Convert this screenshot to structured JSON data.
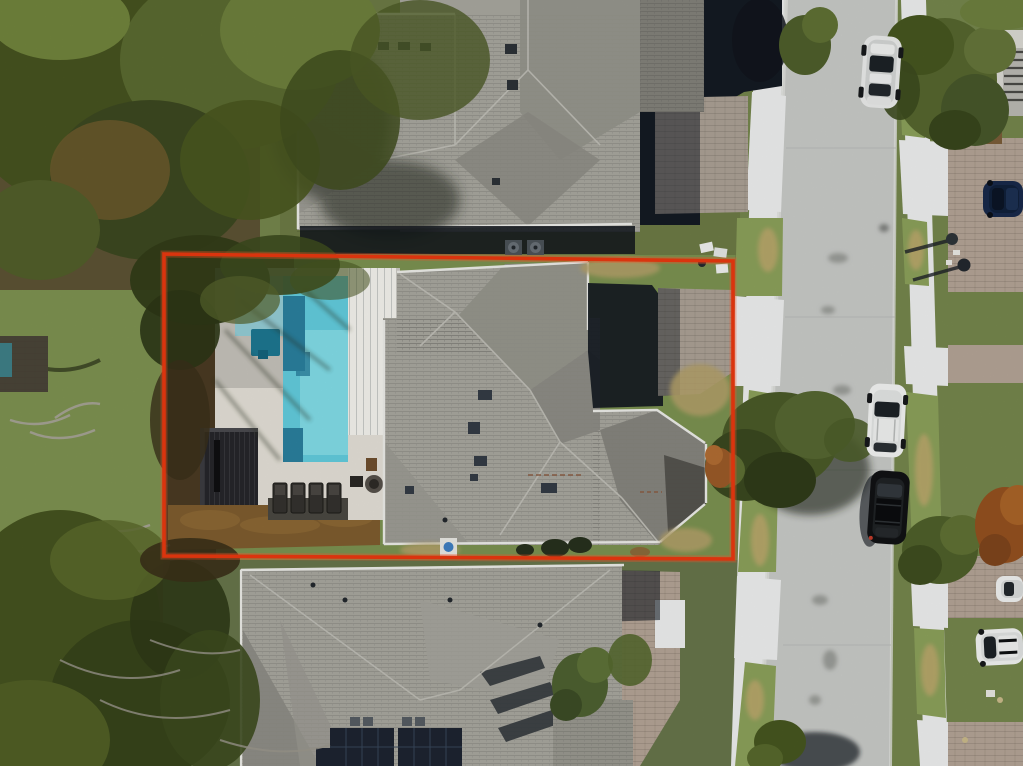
{
  "meta": {
    "type": "aerial-drone-photo",
    "subject": "residential lot highlighted with red boundary, house with swimming pool, street with parked cars",
    "width_px": 1023,
    "height_px": 766
  },
  "colors": {
    "boundary": "#e8380f",
    "grass_base": "#74854c",
    "grass_light": "#8ba05a",
    "grass_tan": "#bfa76d",
    "lawn_lot": "#7b9150",
    "lawn_dry": "#b3a069",
    "canopy_dark": "#39451f",
    "canopy_mid": "#51622e",
    "canopy_light": "#70833c",
    "canopy_brown": "#6e5a31",
    "mulch": "#7e5c2e",
    "mulch_dark": "#4e3a1d",
    "road": "#c7c9c6",
    "road_light": "#d4d6d2",
    "sidewalk": "#eceded",
    "paver": "#aaa094",
    "paver_warm": "#b3a395",
    "roof_light": "#a7a69e",
    "roof_mid": "#94938b",
    "roof_dark": "#82817a",
    "roof_facet_shadow": "#6e6d66",
    "gutter_white": "#ebebe7",
    "shadow_deep": "#141a22",
    "pool_water": "#62cbdc",
    "pool_water_light": "#8adfe8",
    "pool_water_shade": "#93cbd4",
    "pool_dark_step": "#2a7f9d",
    "spa": "#1d7690",
    "deck": "#e3dfd6",
    "deck_shade": "#a09c95",
    "lanai_roof": "#f3f2ec",
    "pergola": "#26262a",
    "car_white": "#f0f1f0",
    "car_black": "#101214",
    "car_navy": "#18294a",
    "car_glass": "#1c2126",
    "solar_panel": "#1d2430",
    "ac_unit": "#3f464e",
    "equipment_blue": "#3f7fc1",
    "shed_teal": "#3e7f86"
  },
  "scene": {
    "boundary_shape": "red rectangle outlining the center lot",
    "houses_visible": 3,
    "pools_visible": 1,
    "counts": {
      "cars": 6,
      "lounge_chairs": 4,
      "mailboxes": 2,
      "solar_panel_arrays": 3,
      "ac_units": 2,
      "trash_bins": 3
    },
    "objects": [
      "subject-house-roof",
      "swimming-pool",
      "spa",
      "covered-lanai",
      "pergola",
      "lounge-chairs",
      "fire-pit-table",
      "pool-equipment-pad",
      "paver-driveway",
      "top-neighbor-house",
      "bottom-neighbor-house",
      "solar-panels",
      "street",
      "left-sidewalk",
      "right-sidewalk",
      "grass-strips",
      "silver-sedan-on-road",
      "white-suv-parked",
      "black-suv-parked",
      "navy-car-driveway",
      "white-car-partial",
      "white-suv-right",
      "mailboxes-with-shadows",
      "oak-tree-over-road",
      "dense-tree-canopy-left",
      "leaf-litter-mulch",
      "trash-bins",
      "teal-shed"
    ]
  }
}
